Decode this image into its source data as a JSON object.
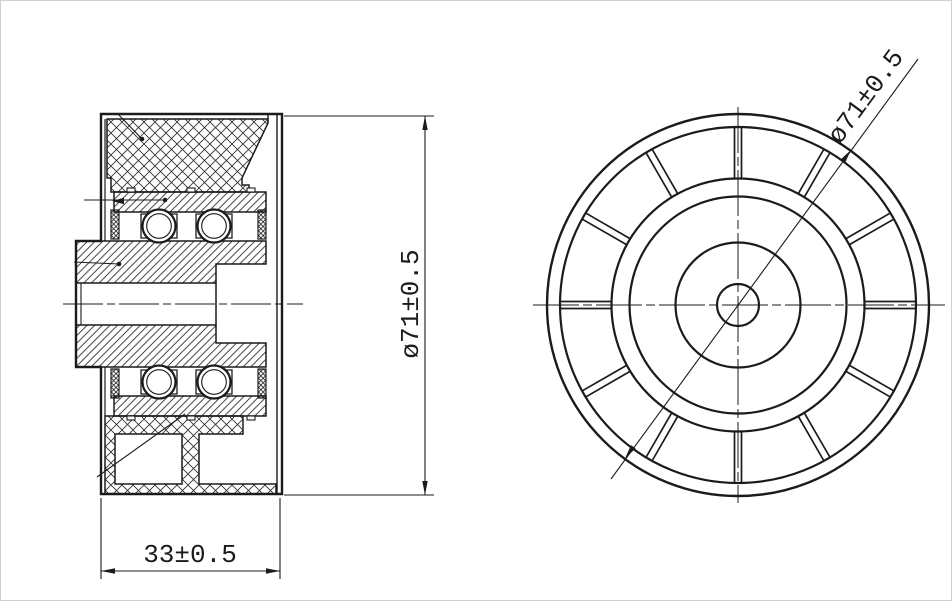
{
  "page": {
    "background": "#ffffff",
    "line_color": "#1b1b1b"
  },
  "drawing": {
    "labels": {
      "diameter": "ø71±0.5",
      "width": "33±0.5"
    },
    "front_view": {
      "spoke_count": 12
    },
    "section_view": {
      "visible_balls": 4,
      "bearing_seals": 4
    }
  }
}
